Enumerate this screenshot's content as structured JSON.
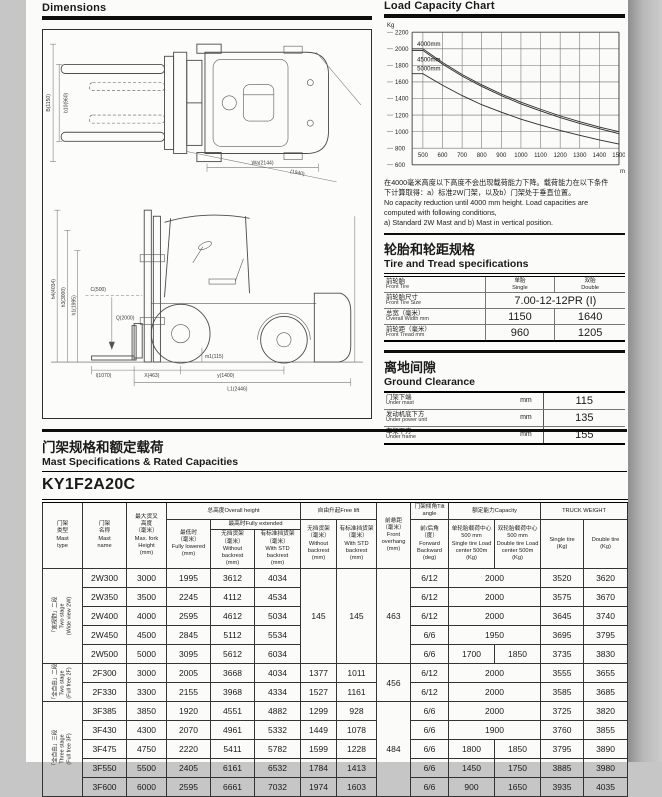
{
  "dimensions": {
    "title": "Dimensions"
  },
  "chart_section": {
    "title": "Load Capacity Chart",
    "notes": [
      "在4000毫米高度以下高度不会出现载荷能力下降。载荷能力在以下条件",
      "下计算取得：a）标准2W门架，以及b）门架处于垂直位置。",
      "No capacity reduction until 4000 mm height. Load capacities are",
      "computed with following conditions,",
      "a) Standard 2W Mast and    b) Mast in vertical position."
    ]
  },
  "chart_data": {
    "type": "line",
    "title": "Load Capacity Chart",
    "xlabel": "mm",
    "ylabel": "Kg",
    "x": [
      500,
      600,
      700,
      800,
      900,
      1000,
      1100,
      1200,
      1300,
      1400,
      1500
    ],
    "yticks": [
      600,
      800,
      1000,
      1200,
      1400,
      1600,
      1800,
      2000,
      2200
    ],
    "ylim": [
      600,
      2200
    ],
    "xlim": [
      445,
      1500
    ],
    "grid": true,
    "legend_position": "inside-left",
    "series": [
      {
        "name": "4000mm",
        "values": [
          2000,
          1835,
          1690,
          1565,
          1455,
          1355,
          1270,
          1190,
          1120,
          1055,
          1000
        ]
      },
      {
        "name": "4500mm",
        "values": [
          1980,
          1815,
          1670,
          1545,
          1435,
          1335,
          1250,
          1170,
          1100,
          1035,
          975
        ]
      },
      {
        "name": "5000mm",
        "values": [
          1700,
          1560,
          1435,
          1325,
          1235,
          1150,
          1080,
          1015,
          955,
          900,
          850
        ]
      }
    ]
  },
  "tire": {
    "title_cn": "轮胎和轮距规格",
    "title_en": "Tire and Tread specifications",
    "col_single": "单胎\nSingle",
    "col_double": "双胎\nDouble",
    "rows": {
      "front_tire": {
        "cn": "前轮胎",
        "en": "Front Tire"
      },
      "tire_size": {
        "cn": "前轮胎尺寸",
        "en": "Front Tire Size",
        "value": "7.00-12-12PR (I)"
      },
      "overall_width": {
        "cn": "总宽（毫米）",
        "en": "Overall Width mm",
        "single": "1150",
        "double": "1640"
      },
      "front_tread": {
        "cn": "前轮距（毫米）",
        "en": "Front Tread mm",
        "single": "960",
        "double": "1205"
      }
    }
  },
  "ground": {
    "title_cn": "离地间隙",
    "title_en": "Ground Clearance",
    "rows": [
      {
        "cn": "门架下端",
        "en": "Under mast",
        "unit": "mm",
        "value": "115"
      },
      {
        "cn": "发动机底下方",
        "en": "Under power unit",
        "unit": "mm",
        "value": "135"
      },
      {
        "cn": "车架下方",
        "en": "Under frame",
        "unit": "mm",
        "value": "155"
      }
    ]
  },
  "mast": {
    "title_cn": "门架规格和额定载荷",
    "title_en": "Mast Specifications & Rated Capacities",
    "model": "KY1F2A20C",
    "headers": {
      "mast_type": "门架\n类型\nMast\ntype",
      "mast_name": "门架\n名称\nMast\nname",
      "max_height": "最大货叉\n高度\n（毫米）\nMax. fork\nHeight\n(mm)",
      "overall": "总高度Overall height",
      "lowered": "最低时\n（毫米）\nFully lowered\n(mm)",
      "extended": "最高时Fully extended",
      "oh_without": "无挡货架\n（毫米）\nWithout\nbackrest\n(mm)",
      "oh_with": "有标准挡货架\n（毫米）\nWith STD\nbackrest\n(mm)",
      "free_lift": "自由升起Free lift",
      "fl_without": "无挡货架\n（毫米）\nWithout\nbackrest\n(mm)",
      "fl_with": "有标准挡货架\n（毫米）\nWith STD\nbackrest\n(mm)",
      "overhang": "前悬距\n（毫米）\nFront\noverhang\n(mm)",
      "tilt": "门架倾角Tilt angle",
      "tilt_sub": "前/后角\n（度）\nForward\nBackward\n(deg)",
      "capacity": "额定能力Capacity",
      "cap_single": "单轮胎载荷中心\n500 mm\nSingle tire Load\ncenter 500m\n(Kg)",
      "cap_double": "双轮胎载荷中心\n500 mm\nDouble tire Load\ncenter 500m\n(Kg)",
      "truck_weight": "TRUCK WEIGHT",
      "w_single": "Single tire\n(Kg)",
      "w_double": "Double tire\n(Kg)"
    },
    "groups": [
      {
        "type_label": "「宽视野」二段\nTwo stage\n(Wide view 2W)",
        "overhang": "463",
        "free_lift": [
          "145",
          "145"
        ],
        "rows": [
          {
            "name": "2W300",
            "max_h": "3000",
            "lowered": "1995",
            "oh_wo": "3612",
            "oh_w": "4034",
            "tilt": "6/12",
            "cap": [
              "2000"
            ],
            "w_single": "3520",
            "w_double": "3620"
          },
          {
            "name": "2W350",
            "max_h": "3500",
            "lowered": "2245",
            "oh_wo": "4112",
            "oh_w": "4534",
            "tilt": "6/12",
            "cap": [
              "2000"
            ],
            "w_single": "3575",
            "w_double": "3670"
          },
          {
            "name": "2W400",
            "max_h": "4000",
            "lowered": "2595",
            "oh_wo": "4612",
            "oh_w": "5034",
            "tilt": "6/12",
            "cap": [
              "2000"
            ],
            "w_single": "3645",
            "w_double": "3740"
          },
          {
            "name": "2W450",
            "max_h": "4500",
            "lowered": "2845",
            "oh_wo": "5112",
            "oh_w": "5534",
            "tilt": "6/6",
            "cap": [
              "1950"
            ],
            "w_single": "3695",
            "w_double": "3795"
          },
          {
            "name": "2W500",
            "max_h": "5000",
            "lowered": "3095",
            "oh_wo": "5612",
            "oh_w": "6034",
            "tilt": "6/6",
            "cap": [
              "1700",
              "1850"
            ],
            "w_single": "3735",
            "w_double": "3830"
          }
        ]
      },
      {
        "type_label": "「全自由」二段\nTwo stage\n(Full free 2F)",
        "overhang": "456",
        "free_lift": null,
        "rows": [
          {
            "name": "2F300",
            "max_h": "3000",
            "lowered": "2005",
            "oh_wo": "3668",
            "oh_w": "4034",
            "fl_wo": "1377",
            "fl_w": "1011",
            "tilt": "6/12",
            "cap": [
              "2000"
            ],
            "w_single": "3555",
            "w_double": "3655"
          },
          {
            "name": "2F330",
            "max_h": "3300",
            "lowered": "2155",
            "oh_wo": "3968",
            "oh_w": "4334",
            "fl_wo": "1527",
            "fl_w": "1161",
            "tilt": "6/12",
            "cap": [
              "2000"
            ],
            "w_single": "3585",
            "w_double": "3685"
          }
        ]
      },
      {
        "type_label": "「全自由」三段\nThree stage\n(Full free 3F)",
        "overhang": "484",
        "free_lift": null,
        "rows": [
          {
            "name": "3F385",
            "max_h": "3850",
            "lowered": "1920",
            "oh_wo": "4551",
            "oh_w": "4882",
            "fl_wo": "1299",
            "fl_w": "928",
            "tilt": "6/6",
            "cap": [
              "2000"
            ],
            "w_single": "3725",
            "w_double": "3820"
          },
          {
            "name": "3F430",
            "max_h": "4300",
            "lowered": "2070",
            "oh_wo": "4961",
            "oh_w": "5332",
            "fl_wo": "1449",
            "fl_w": "1078",
            "tilt": "6/6",
            "cap": [
              "1900"
            ],
            "w_single": "3760",
            "w_double": "3855"
          },
          {
            "name": "3F475",
            "max_h": "4750",
            "lowered": "2220",
            "oh_wo": "5411",
            "oh_w": "5782",
            "fl_wo": "1599",
            "fl_w": "1228",
            "tilt": "6/6",
            "cap": [
              "1800",
              "1850"
            ],
            "w_single": "3795",
            "w_double": "3890"
          },
          {
            "name": "3F550",
            "max_h": "5500",
            "lowered": "2405",
            "oh_wo": "6161",
            "oh_w": "6532",
            "fl_wo": "1784",
            "fl_w": "1413",
            "tilt": "6/6",
            "cap": [
              "1450",
              "1750"
            ],
            "w_single": "3885",
            "w_double": "3980"
          },
          {
            "name": "3F600",
            "max_h": "6000",
            "lowered": "2595",
            "oh_wo": "6661",
            "oh_w": "7032",
            "fl_wo": "1974",
            "fl_w": "1603",
            "tilt": "6/6",
            "cap": [
              "900",
              "1650"
            ],
            "w_single": "3935",
            "w_double": "4035"
          }
        ]
      }
    ]
  },
  "drawings": {
    "top": [
      "B(1150)",
      "b10(960)",
      "Wa(2144)",
      "(1940)"
    ],
    "side": [
      "h4(4034)",
      "h3(3000)",
      "h1(1995)",
      "Q(2000)",
      "C(500)",
      "m1(115)",
      "X(463)",
      "y(1400)",
      "L1(2446)",
      "l(1070)"
    ]
  }
}
